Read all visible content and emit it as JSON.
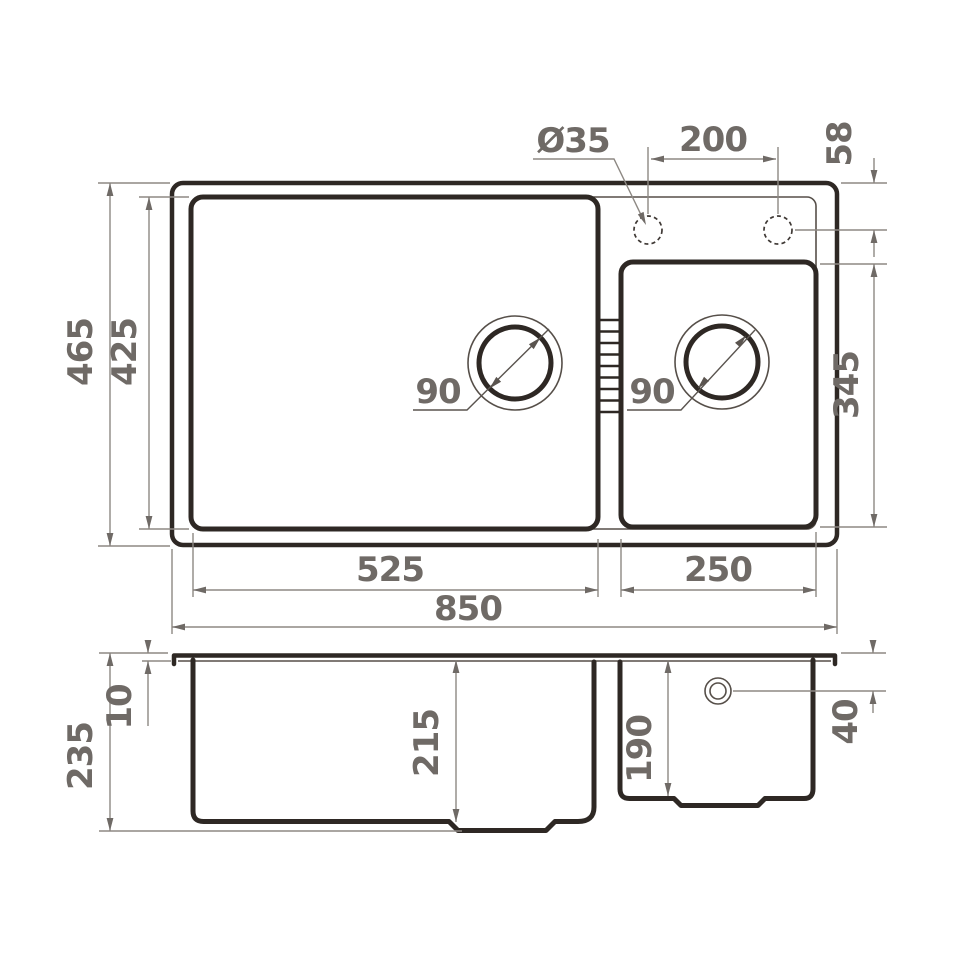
{
  "drawing_title": "Double-bowl kitchen sink dimension drawing",
  "colors": {
    "geometry_line": "#2e2824",
    "thin_line": "#564f49",
    "dimension_line": "#8d8883",
    "dimension_text": "#6f6a66",
    "background": "#ffffff"
  },
  "top_view": {
    "overall_width": "850",
    "overall_depth": "465",
    "inner_depth": "425",
    "bowl1": {
      "width": "525",
      "drain_diameter": "90"
    },
    "bowl2": {
      "width": "250",
      "length": "345",
      "drain_diameter": "90"
    },
    "faucet_hole_diameter": "Ø35",
    "faucet_hole_spacing": "200",
    "faucet_hole_offset": "58"
  },
  "section_view": {
    "overall_height": "235",
    "rim_thickness": "10",
    "bowl1_depth": "215",
    "bowl2_depth": "190",
    "overflow_offset": "40"
  }
}
